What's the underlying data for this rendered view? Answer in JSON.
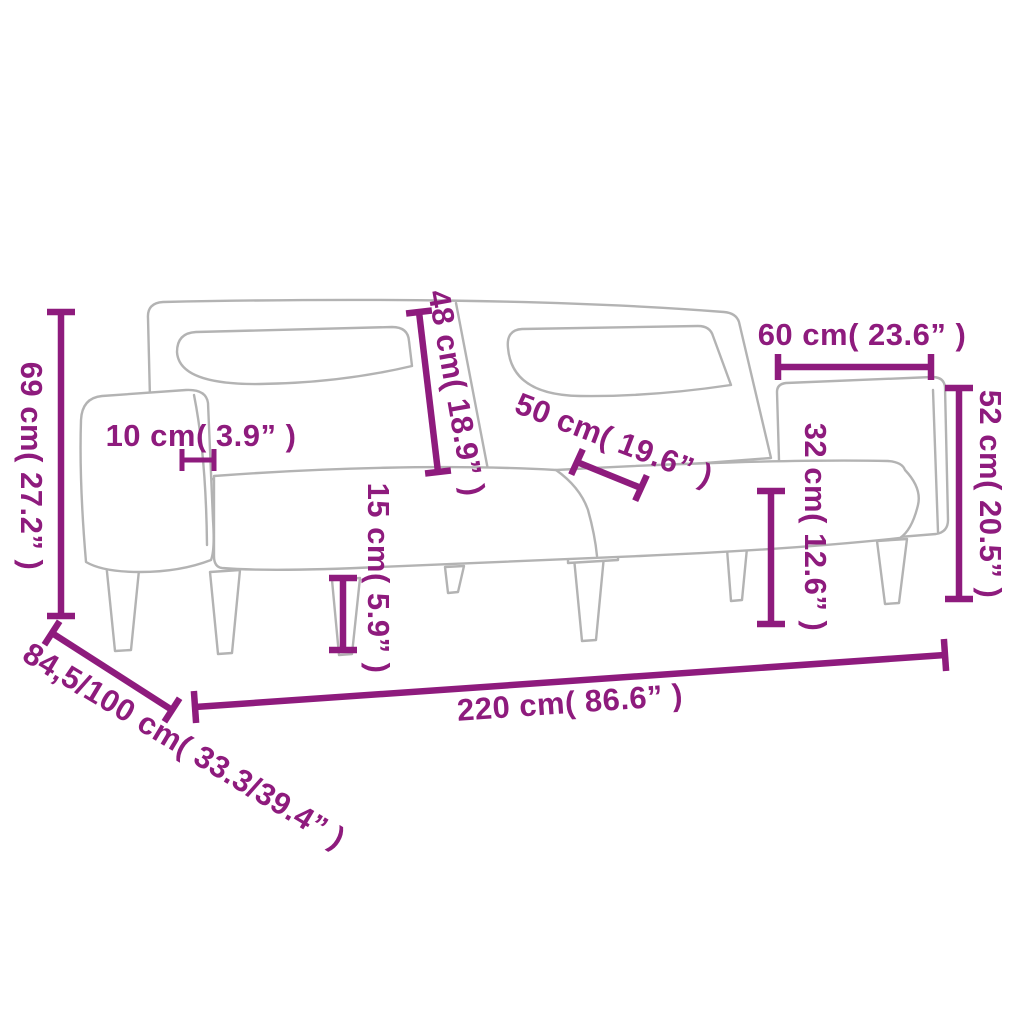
{
  "diagram": {
    "description": "Dimension diagram of a 2-seater sofa bed with wooden legs",
    "accent_color": "#8e1b7d",
    "line_art_color": "#b3b3b3",
    "background_color": "#ffffff"
  },
  "dimensions": [
    {
      "id": "overall-height",
      "label": "69 cm( 27.2” )"
    },
    {
      "id": "armrest-width",
      "label": "10 cm( 3.9” )"
    },
    {
      "id": "backrest-height",
      "label": "48 cm( 18.9” )"
    },
    {
      "id": "seat-depth",
      "label": "50 cm( 19.6” )"
    },
    {
      "id": "folded-section-width",
      "label": "60 cm( 23.6” )"
    },
    {
      "id": "folded-section-height",
      "label": "52 cm( 20.5” )"
    },
    {
      "id": "seat-height",
      "label": "32 cm( 12.6” )"
    },
    {
      "id": "leg-height",
      "label": "15 cm( 5.9” )"
    },
    {
      "id": "overall-width",
      "label": "220 cm( 86.6” )"
    },
    {
      "id": "overall-depth",
      "label": "84,5/100 cm( 33.3/39.4” )"
    }
  ]
}
